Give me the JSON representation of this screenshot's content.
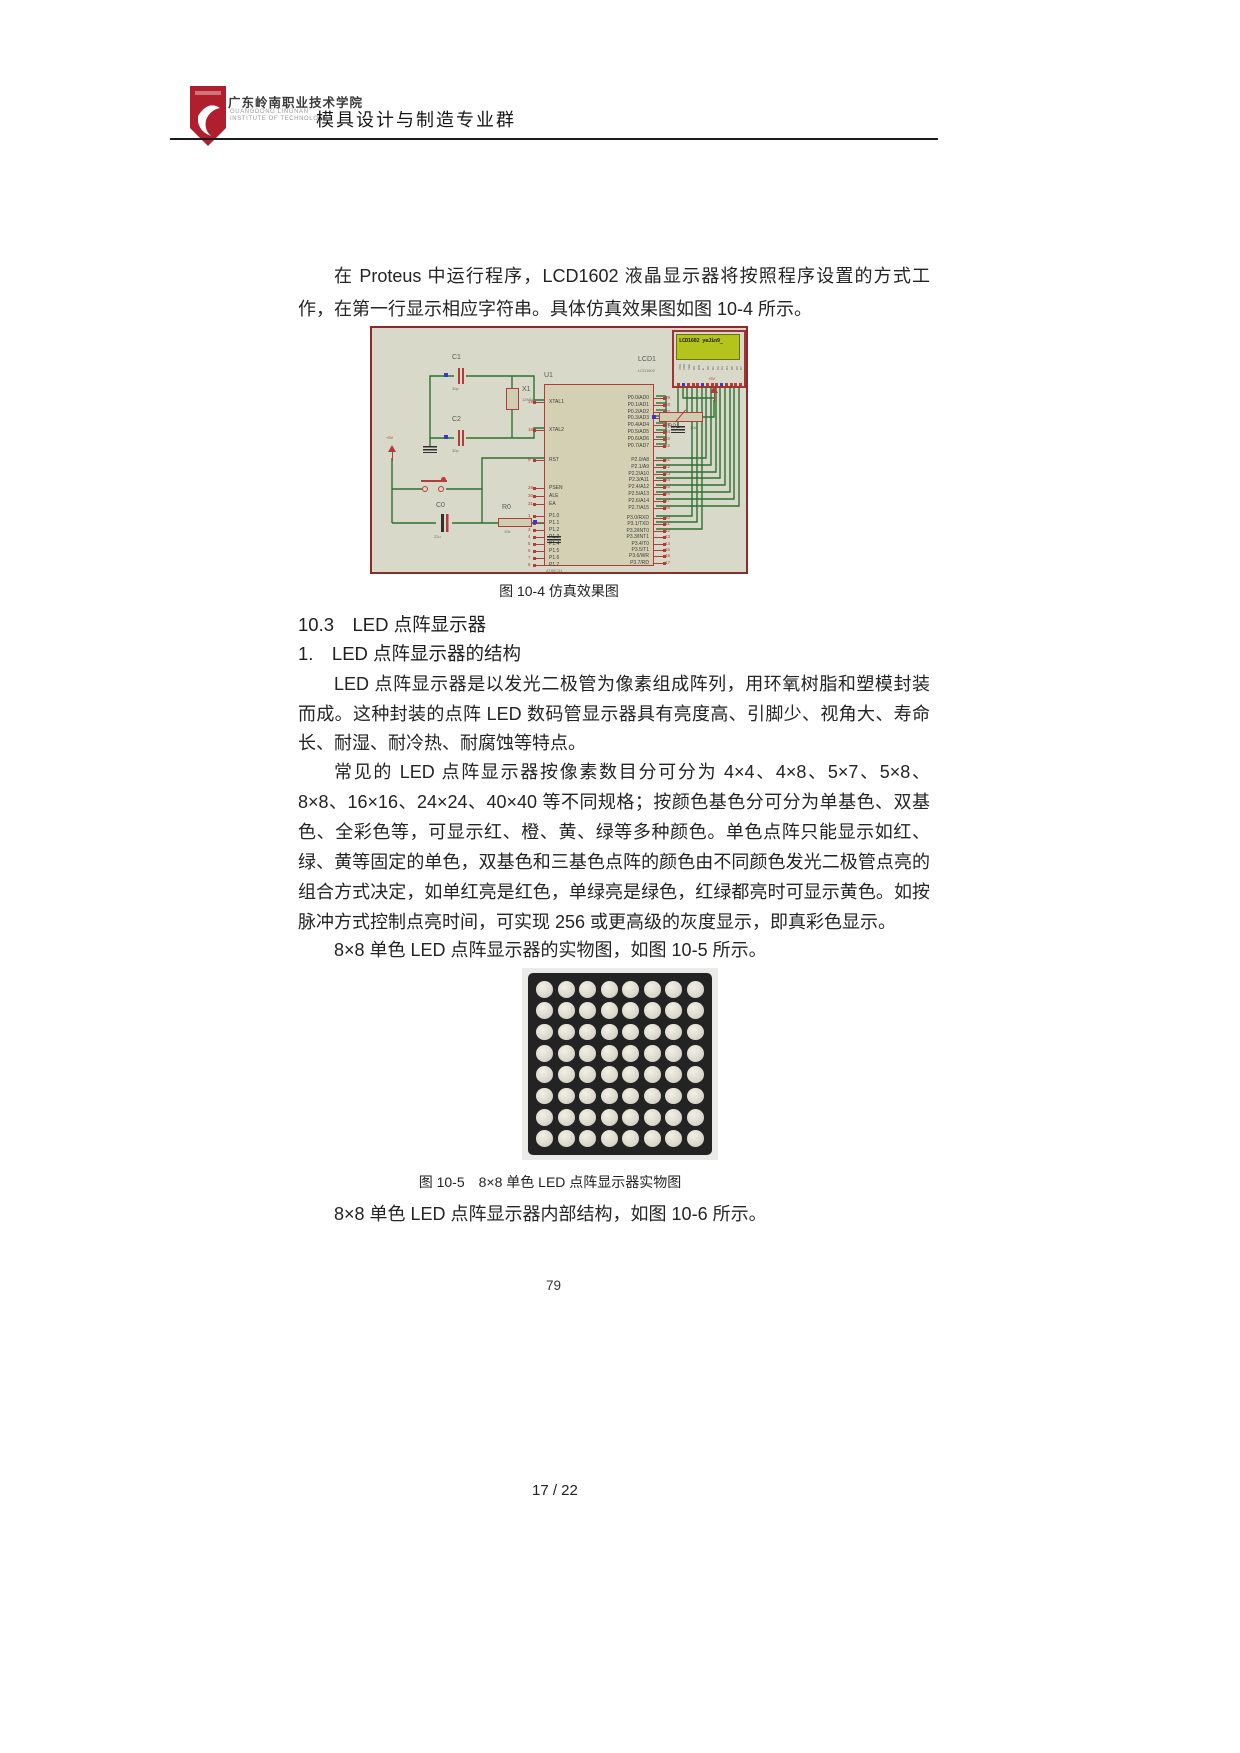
{
  "header": {
    "college": "广东岭南职业技术学院",
    "college_en1": "GUANGDONG LINGNAN",
    "college_en2": "INSTITUTE OF TECHNOLOGY",
    "title": "模具设计与制造专业群"
  },
  "content": {
    "p1": "在 Proteus 中运行程序，LCD1602 液晶显示器将按照程序设置的方式工作，在第一行显示相应字符串。具体仿真效果图如图 10-4 所示。",
    "fig4_caption": "图 10-4  仿真效果图",
    "sec_title": "10.3　LED 点阵显示器",
    "sub_title": "1.　LED 点阵显示器的结构",
    "p2": "LED 点阵显示器是以发光二极管为像素组成阵列，用环氧树脂和塑模封装而成。这种封装的点阵 LED 数码管显示器具有亮度高、引脚少、视角大、寿命长、耐湿、耐冷热、耐腐蚀等特点。",
    "p3": "常见的 LED 点阵显示器按像素数目分可分为 4×4、4×8、5×7、5×8、8×8、16×16、24×24、40×40 等不同规格；按颜色基色分可分为单基色、双基色、全彩色等，可显示红、橙、黄、绿等多种颜色。单色点阵只能显示如红、绿、黄等固定的单色，双基色和三基色点阵的颜色由不同颜色发光二极管点亮的组合方式决定，如单红亮是红色，单绿亮是绿色，红绿都亮时可显示黄色。如按脉冲方式控制点亮时间，可实现 256 或更高级的灰度显示，即真彩色显示。",
    "p4": "8×8 单色 LED 点阵显示器的实物图，如图 10-5 所示。",
    "fig5_caption": "图 10-5　8×8 单色 LED 点阵显示器实物图",
    "p5": "8×8 单色 LED 点阵显示器内部结构，如图 10-6 所示。",
    "book_page": "79",
    "doc_page": "17 / 22"
  },
  "fig4": {
    "lcd_screen_text": "LCD1602 yeJin9_",
    "lcd_ref": "LCD1",
    "lcd_type": "LCD1602",
    "u1_ref": "U1",
    "u1_type": "AT89C51",
    "pwr": "+5V",
    "c1": {
      "ref": "C1",
      "val": "30p"
    },
    "c2": {
      "ref": "C2",
      "val": "30p"
    },
    "x1": {
      "ref": "X1",
      "val": "12MHz"
    },
    "c0": {
      "ref": "C0",
      "val": "22u"
    },
    "r0": {
      "ref": "R0",
      "val": "10k"
    },
    "rp1": {
      "ref": "RP1",
      "val": "10k"
    },
    "u1_left_pins": [
      {
        "n": "19",
        "label": "XTAL1"
      },
      {
        "n": "18",
        "label": "XTAL2"
      },
      {
        "n": "9",
        "label": "RST"
      },
      {
        "n": "29",
        "label": "PSEN"
      },
      {
        "n": "30",
        "label": "ALE"
      },
      {
        "n": "31",
        "label": "EA"
      },
      {
        "n": "1",
        "label": "P1.0"
      },
      {
        "n": "2",
        "label": "P1.1"
      },
      {
        "n": "3",
        "label": "P1.2"
      },
      {
        "n": "4",
        "label": "P1.3"
      },
      {
        "n": "5",
        "label": "P1.4"
      },
      {
        "n": "6",
        "label": "P1.5"
      },
      {
        "n": "7",
        "label": "P1.6"
      },
      {
        "n": "8",
        "label": "P1.7"
      }
    ],
    "u1_right_pins": [
      {
        "n": "39",
        "label": "P0.0/AD0"
      },
      {
        "n": "38",
        "label": "P0.1/AD1"
      },
      {
        "n": "37",
        "label": "P0.2/AD2"
      },
      {
        "n": "36",
        "label": "P0.3/AD3"
      },
      {
        "n": "35",
        "label": "P0.4/AD4"
      },
      {
        "n": "34",
        "label": "P0.5/AD5"
      },
      {
        "n": "33",
        "label": "P0.6/AD6"
      },
      {
        "n": "32",
        "label": "P0.7/AD7"
      },
      {
        "n": "21",
        "label": "P2.0/A8"
      },
      {
        "n": "22",
        "label": "P2.1/A9"
      },
      {
        "n": "23",
        "label": "P2.2/A10"
      },
      {
        "n": "24",
        "label": "P2.3/A11"
      },
      {
        "n": "25",
        "label": "P2.4/A12"
      },
      {
        "n": "26",
        "label": "P2.5/A13"
      },
      {
        "n": "27",
        "label": "P2.6/A14"
      },
      {
        "n": "28",
        "label": "P2.7/A15"
      },
      {
        "n": "10",
        "label": "P3.0/RXD"
      },
      {
        "n": "11",
        "label": "P3.1/TXD"
      },
      {
        "n": "12",
        "label": "P3.2/INT0"
      },
      {
        "n": "13",
        "label": "P3.3/INT1"
      },
      {
        "n": "14",
        "label": "P3.4/T0"
      },
      {
        "n": "15",
        "label": "P3.5/T1"
      },
      {
        "n": "16",
        "label": "P3.6/WR"
      },
      {
        "n": "17",
        "label": "P3.7/RD"
      }
    ],
    "lcd_pins": [
      "VSS",
      "VDD",
      "VEE",
      "RS",
      "RW",
      "E",
      "D0",
      "D1",
      "D2",
      "D3",
      "D4",
      "D5",
      "D6",
      "D7"
    ]
  },
  "fig5": {
    "rows": 8,
    "cols": 8
  },
  "colors": {
    "schematic_bg": "#d9d9c9",
    "schematic_border": "#8d2a2a",
    "wire_green": "#2e7032",
    "pin_red": "#b23b3b",
    "pad_blue": "#3939c8",
    "lcd_screen_green": "#b5c41d",
    "logo_red": "#b01f2e",
    "matrix_black": "#232323",
    "matrix_dot": "#dddbcd"
  }
}
